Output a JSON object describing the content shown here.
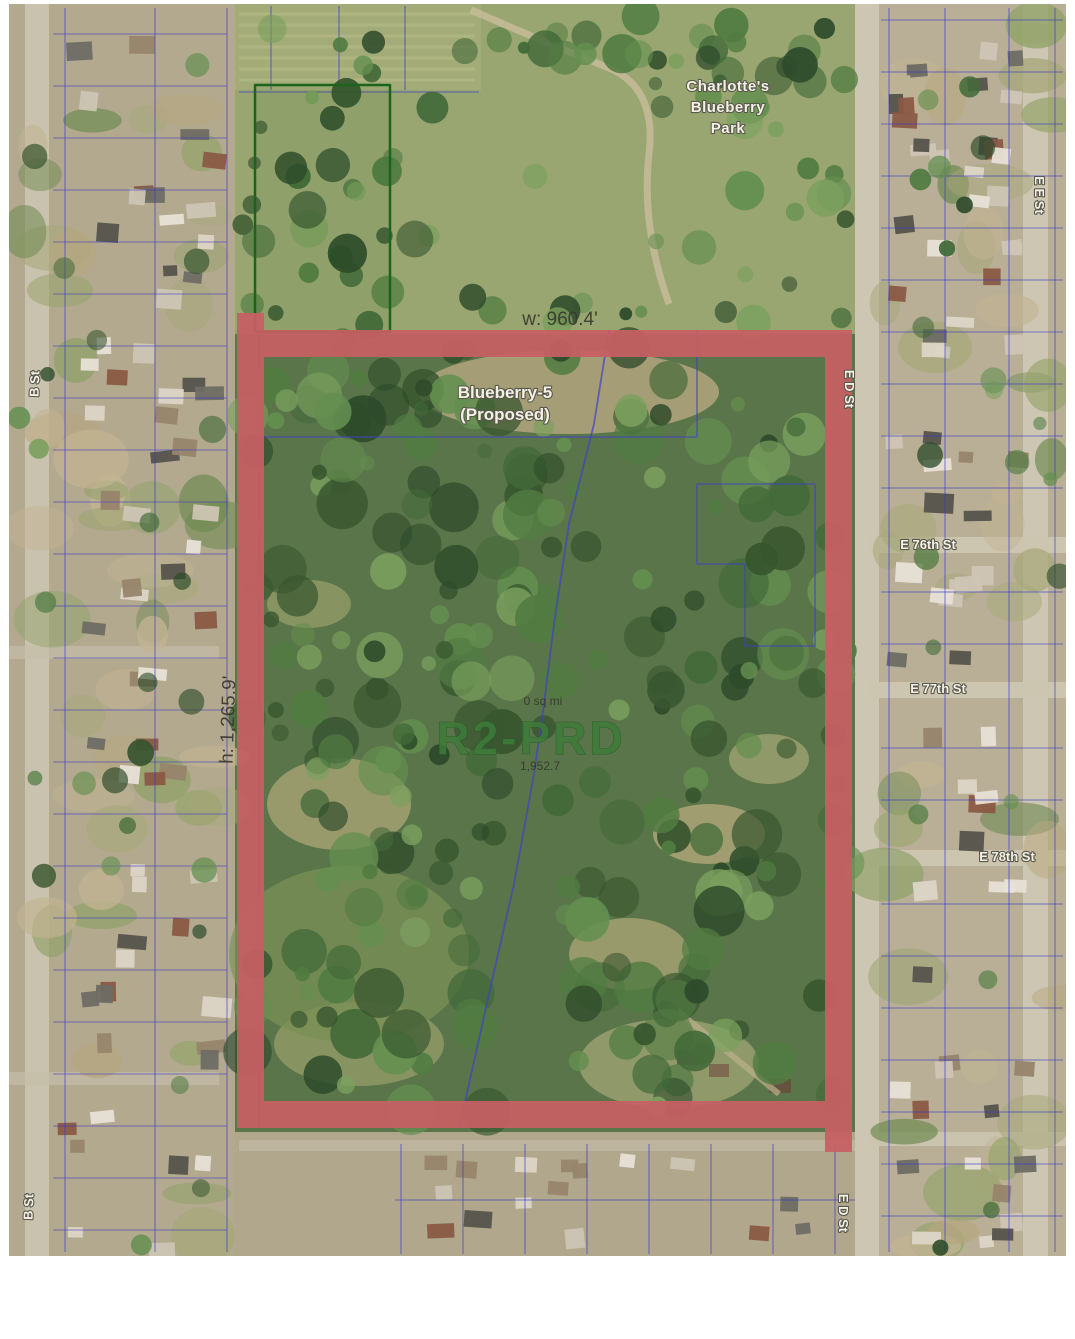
{
  "page": {
    "background": "#ffffff"
  },
  "map": {
    "park_name": {
      "line1": "Charlotte's",
      "line2": "Blueberry",
      "line3": "Park"
    },
    "boundary": {
      "width_label": "w: 960.4'",
      "height_label": "h: 1,265.9'"
    },
    "site": {
      "proposed_line1": "Blueberry-5",
      "proposed_line2": "(Proposed)",
      "zoning": "R2-PRD",
      "area_sq_mi": "0 sq mi",
      "area_value": "1,952.7"
    },
    "streets": {
      "e_76th": "E 76th St",
      "e_77th": "E 77th St",
      "e_78th": "E 78th St",
      "e_e_st": "E E St",
      "e_d_st_upper": "E D St",
      "e_d_st_lower": "E D St",
      "b_st_upper": "B St",
      "b_st_lower": "B St"
    },
    "colors": {
      "boundary_red": "#c75f63",
      "parcel_blue": "#3838c6",
      "zoning_green": "#3d7c3a",
      "park_green_outline": "#1c641c"
    }
  }
}
